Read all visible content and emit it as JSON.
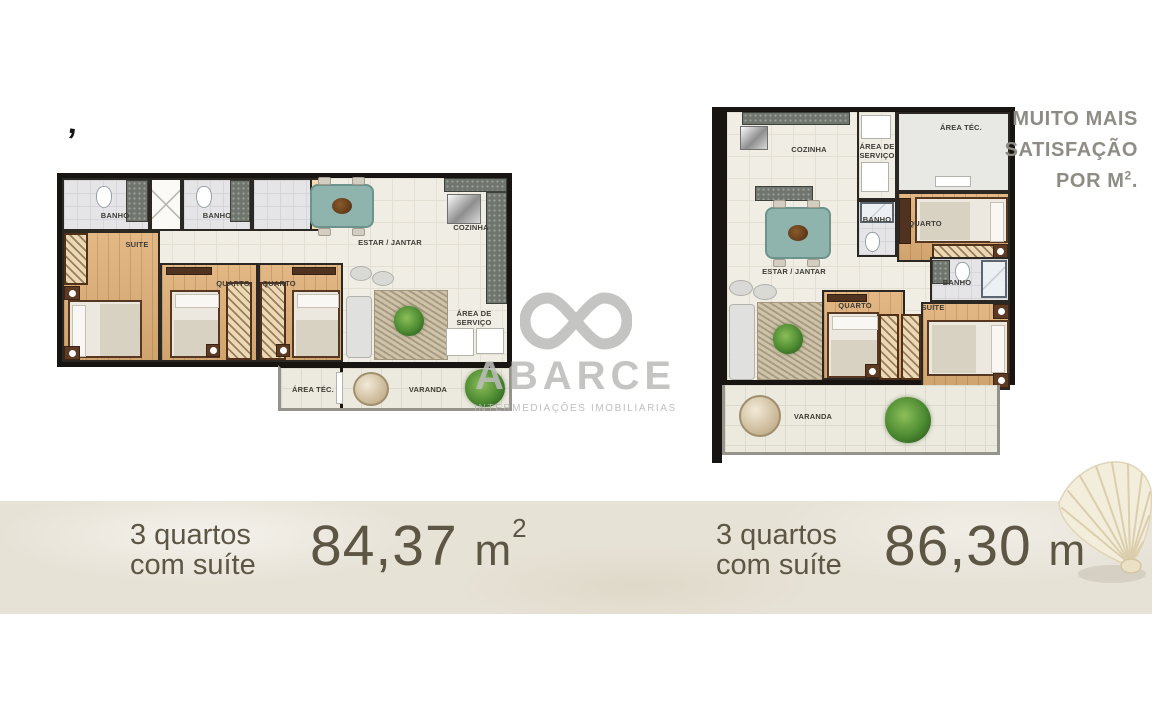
{
  "note": {
    "line1": "MUITO MAIS",
    "line2": "SATISFAÇÃO",
    "line3_text": "POR M",
    "line3_sup": "2",
    "line3_end": "."
  },
  "decor_mark": "’",
  "watermark": {
    "brand": "ABARCE",
    "tagline": "INTERMEDIAÇÕES IMOBILIARIAS"
  },
  "plan_a": {
    "rooms": {
      "banho1": "BANHO",
      "banho2": "BANHO",
      "suite": "SUITE",
      "quarto1": "QUARTO",
      "quarto2": "QUARTO",
      "estar": "ESTAR / JANTAR",
      "cozinha": "COZINHA",
      "servico": "ÁREA DE SERVIÇO",
      "area_tec": "ÁREA TÉC.",
      "varanda": "VARANDA"
    }
  },
  "plan_b": {
    "rooms": {
      "cozinha": "COZINHA",
      "servico": "ÁREA DE SERVIÇO",
      "area_tec": "ÁREA TÉC.",
      "quarto_top": "QUARTO",
      "banho_meio": "BANHO",
      "estar": "ESTAR / JANTAR",
      "banho_suite": "BANHO",
      "quarto_baixo": "QUARTO",
      "suite": "SUÍTE",
      "varanda": "VARANDA"
    }
  },
  "summaries": [
    {
      "line1": "3 quartos",
      "line2": "com suíte",
      "value": "84,37",
      "unit": "m",
      "unit_sup": "2"
    },
    {
      "line1": "3 quartos",
      "line2": "com suíte",
      "value": "86,30",
      "unit": "m",
      "unit_sup": "2"
    }
  ],
  "colors": {
    "accent_text": "#5d5645",
    "note_text": "#8f8c85",
    "watermark": "#bcbbb9",
    "wall": "#171411",
    "wood": "#e0b077",
    "teal_table": "#8fb4ae",
    "sand_band": "#e7e2d6"
  }
}
